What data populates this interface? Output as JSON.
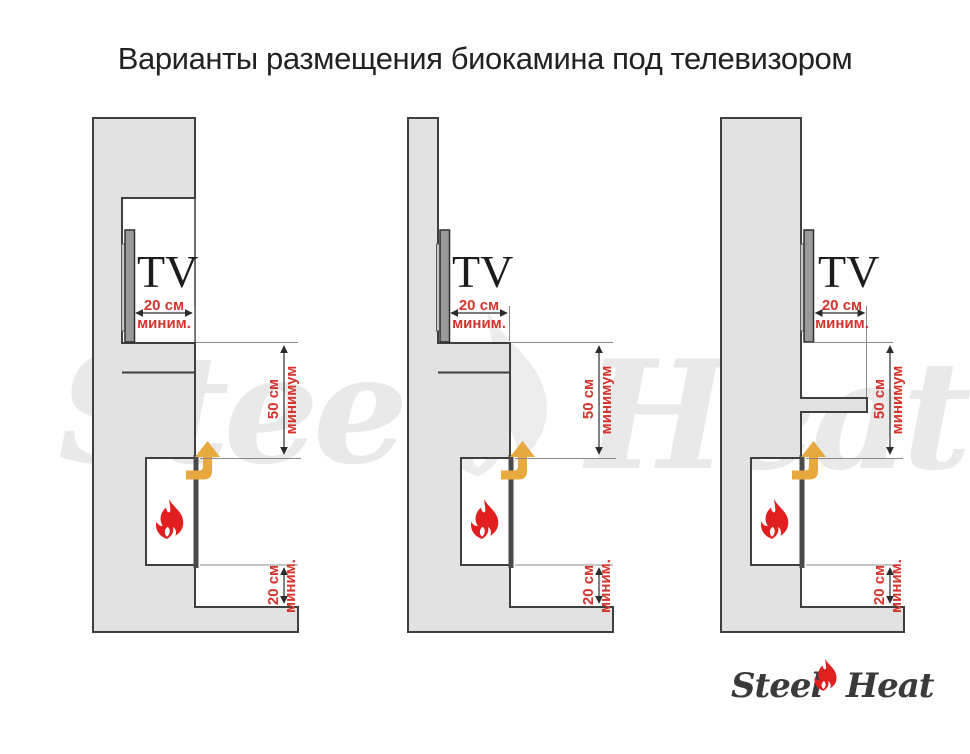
{
  "title": "Варианты размещения биокамина под телевизором",
  "watermark": {
    "word_left": "Steel",
    "word_right": "Heat"
  },
  "logo": {
    "word_left": "Steel",
    "word_right": "Heat"
  },
  "diagrams": [
    {
      "id": "variant-1",
      "tv_label": "TV",
      "tv_offset_value": "20 см",
      "tv_offset_qualifier": "миним.",
      "tv_to_fireplace_value": "50 см",
      "tv_to_fireplace_qualifier": "минимум",
      "fireplace_to_base_value": "20 см",
      "fireplace_to_base_qualifier": "миним."
    },
    {
      "id": "variant-2",
      "tv_label": "TV",
      "tv_offset_value": "20 см",
      "tv_offset_qualifier": "миним.",
      "tv_to_fireplace_value": "50 см",
      "tv_to_fireplace_qualifier": "минимум",
      "fireplace_to_base_value": "20 см",
      "fireplace_to_base_qualifier": "миним."
    },
    {
      "id": "variant-3",
      "tv_label": "TV",
      "tv_offset_value": "20 см",
      "tv_offset_qualifier": "миним.",
      "tv_to_fireplace_value": "50 см",
      "tv_to_fireplace_qualifier": "минимум",
      "fireplace_to_base_value": "20 см",
      "fireplace_to_base_qualifier": "миним."
    }
  ],
  "colors": {
    "wall_fill": "#e2e2e2",
    "outline": "#3f3f3f",
    "dimension_text": "#d4342c",
    "flame_red": "#e11f1f",
    "arrow_amber": "#e7a93d",
    "watermark_gray": "#e9e9e9",
    "tv_panel": "#9a9a9a"
  }
}
